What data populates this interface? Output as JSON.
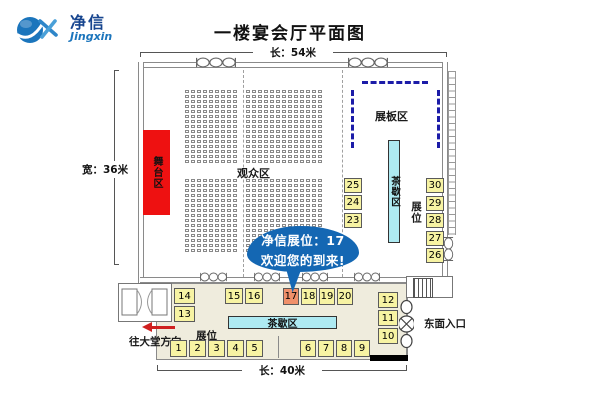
{
  "logo": {
    "cn": "净信",
    "en": "Jingxin"
  },
  "title": "一楼宴会厅平面图",
  "dims": {
    "top": "长：54米",
    "left": "宽：36米",
    "bottom": "长：40米"
  },
  "areas": {
    "stage": "舞台区",
    "audience": "观众区",
    "display_board": "展板区",
    "tea_right": "茶歇区",
    "tea_bottom": "茶歇区",
    "booths_right": "展位",
    "booths_bottom": "展位"
  },
  "bubble": {
    "line1": "净信展位：17",
    "line2": "欢迎您的到来!"
  },
  "notes": {
    "to_lobby": "往大堂方向",
    "east_entrance": "东面入口"
  },
  "booths": {
    "highlight": "17",
    "right_inner": [
      "25",
      "24",
      "23"
    ],
    "right_outer": [
      "30",
      "29",
      "28",
      "27",
      "26"
    ],
    "left_stack": [
      "14",
      "13"
    ],
    "mid_left": [
      "15",
      "16"
    ],
    "mid_right": [
      "17",
      "18",
      "19",
      "20"
    ],
    "bottom_left": [
      "1",
      "2",
      "3",
      "4",
      "5"
    ],
    "bottom_right": [
      "6",
      "7",
      "8",
      "9"
    ],
    "east_stack": [
      "12",
      "11",
      "10"
    ]
  },
  "seating": {
    "blocks": 2,
    "rows_per_block": 15,
    "cols_left_group": 9,
    "cols_right_group": 13
  },
  "colors": {
    "stage_red": "#ee1111",
    "booth_yellow": "#f7f3a3",
    "booth_highlight": "#f0906a",
    "tea_cyan": "#aeeaf2",
    "bubble_blue": "#1467b3",
    "dash_navy": "#1c1ca8",
    "logo_blue": "#1b75bc",
    "logo_dark": "#17458f",
    "arrow_red": "#cf2020",
    "corridor_bg": "#efecdd"
  }
}
